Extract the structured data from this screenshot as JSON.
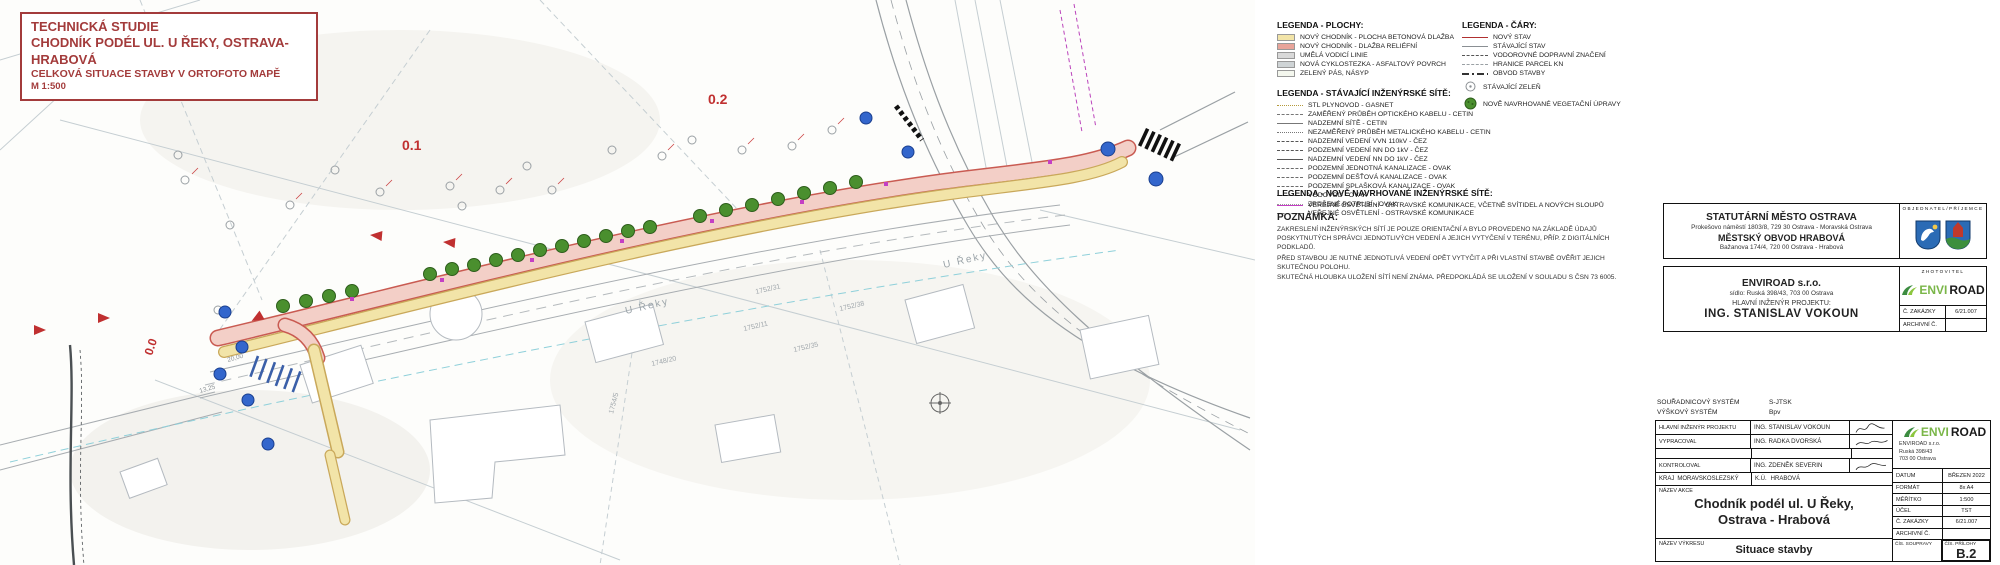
{
  "colors": {
    "title_red": "#a33b3b",
    "sidewalk_yellow": "#f2e4a8",
    "relief_red": "#e8a49a",
    "guide_gray": "#d9d9d9",
    "cycle_gray": "#cfd4d6",
    "green_strip": "#f4f7ee",
    "new_state_red": "#b03030",
    "lighting_magenta": "#c43fc4",
    "tree_green": "#4a8f2e",
    "sign_blue": "#3366cc",
    "logo_green": "#7ab648"
  },
  "title_box": {
    "line1": "TECHNICKÁ STUDIE",
    "line2": "CHODNÍK PODÉL UL. U ŘEKY, OSTRAVA-HRABOVÁ",
    "line3": "CELKOVÁ SITUACE STAVBY V ORTOFOTO MAPĚ",
    "line4": "M 1:500"
  },
  "legend_plochy": {
    "title": "LEGENDA - PLOCHY:",
    "items": [
      {
        "label": "NOVÝ CHODNÍK - PLOCHA BETONOVÁ DLAŽBA",
        "swatch": "#f2e4a8"
      },
      {
        "label": "NOVÝ CHODNÍK - DLAŽBA RELIÉFNÍ",
        "swatch": "#e8a49a"
      },
      {
        "label": "UMĚLÁ VODICÍ LINIE",
        "swatch": "#d9d9d9"
      },
      {
        "label": "NOVÁ CYKLOSTEZKA - ASFALTOVÝ POVRCH",
        "swatch": "#cfd4d6"
      },
      {
        "label": "ZELENÝ PÁS, NÁSYP",
        "swatch": "#f4f7ee"
      }
    ]
  },
  "legend_cary": {
    "title": "LEGENDA - ČÁRY:",
    "items": [
      {
        "label": "NOVÝ STAV",
        "style": "ln-s",
        "color": "#b03030"
      },
      {
        "label": "STÁVAJÍCÍ STAV",
        "style": "ln-s",
        "color": "#8a8f93"
      },
      {
        "label": "VODOROVNÉ DOPRAVNÍ ZNAČENÍ",
        "style": "ln-d",
        "color": "#555555"
      },
      {
        "label": "HRANICE PARCEL KN",
        "style": "ln-d",
        "color": "#9aa0a4"
      },
      {
        "label": "OBVOD STAVBY",
        "style": "ln-dd",
        "color": "#333333"
      }
    ],
    "symbols": [
      {
        "label": "STÁVAJÍCÍ ZELEŇ"
      },
      {
        "label": "NOVĚ NAVRHOVANÉ VEGETAČNÍ ÚPRAVY"
      }
    ]
  },
  "legend_stavajici": {
    "title": "LEGENDA - STÁVAJÍCÍ INŽENÝRSKÉ SÍTĚ:",
    "items": [
      {
        "label": "STL PLYNOVOD - GASNET",
        "style": "ln-t",
        "color": "#b59a3c"
      },
      {
        "label": "ZAMĚŘENÝ PRŮBĚH OPTICKÉHO KABELU - CETIN",
        "style": "ln-d",
        "color": "#777777"
      },
      {
        "label": "NADZEMNÍ SÍTĚ - CETIN",
        "style": "ln-s",
        "color": "#777777"
      },
      {
        "label": "NEZAMĚŘENÝ PRŮBĚH METALICKÉHO KABELU - CETIN",
        "style": "ln-t",
        "color": "#777777"
      },
      {
        "label": "NADZEMNÍ VEDENÍ VVN 110kV - ČEZ",
        "style": "ln-d",
        "color": "#555555"
      },
      {
        "label": "PODZEMNÍ VEDENÍ NN DO 1kV - ČEZ",
        "style": "ln-d",
        "color": "#555555"
      },
      {
        "label": "NADZEMNÍ VEDENÍ NN DO 1kV - ČEZ",
        "style": "ln-s",
        "color": "#555555"
      },
      {
        "label": "PODZEMNÍ JEDNOTNÁ KANALIZACE - OVAK",
        "style": "ln-d",
        "color": "#6b6b6b"
      },
      {
        "label": "PODZEMNÍ DEŠŤOVÁ KANALIZACE - OVAK",
        "style": "ln-d",
        "color": "#6b6b6b"
      },
      {
        "label": "PODZEMNÍ SPLAŠKOVÁ KANALIZACE - OVAK",
        "style": "ln-d",
        "color": "#6b6b6b"
      },
      {
        "label": "VODOVOD - OVAK",
        "style": "ln-s",
        "color": "#6b6b6b"
      },
      {
        "label": "ZRUŠENÉ POTRUBÍ - OVAK",
        "style": "ln-t",
        "color": "#999999"
      },
      {
        "label": "VEŘEJNÉ OSVĚTLENÍ - OSTRAVSKÉ KOMUNIKACE",
        "style": "ln-d",
        "color": "#888888"
      }
    ]
  },
  "legend_nove": {
    "title": "LEGENDA - NOVĚ NAVRHOVANÉ INŽENÝRSKÉ SÍTĚ:",
    "items": [
      {
        "label": "VEŘEJNÉ OSVĚTLENÍ - OSTRAVSKÉ KOMUNIKACE, VČETNĚ SVÍTIDEL A NOVÝCH SLOUPŮ",
        "style": "ln-s",
        "color": "#c43fc4"
      }
    ]
  },
  "poznamka": {
    "title": "POZNÁMKA:",
    "lines": [
      "ZAKRESLENÍ INŽENÝRSKÝCH SÍTÍ JE POUZE ORIENTAČNÍ A BYLO PROVEDENO NA ZÁKLADĚ ÚDAJŮ POSKYTNUTÝCH SPRÁVCI JEDNOTLIVÝCH VEDENÍ A JEJICH VYTYČENÍ V TERÉNU, PŘÍP. Z DIGITÁLNÍCH PODKLADŮ.",
      "PŘED STAVBOU JE NUTNÉ JEDNOTLIVÁ VEDENÍ OPĚT VYTYČIT A PŘI VLASTNÍ STAVBĚ OVĚŘIT JEJICH SKUTEČNOU POLOHU.",
      "SKUTEČNÁ HLOUBKA ULOŽENÍ SÍTÍ NENÍ ZNÁMA. PŘEDPOKLÁDÁ SE ULOŽENÍ V SOULADU S ČSN 73 6005."
    ]
  },
  "map": {
    "stations": [
      "0.0",
      "0.1",
      "0.2"
    ],
    "street_label": "U Řeky",
    "parcels": [
      "1752/31",
      "1752/11",
      "1752/38",
      "1752/35",
      "1748/20",
      "1754/5"
    ],
    "dimensions": [
      "20,00",
      "13,25"
    ]
  },
  "owner_block": {
    "corner_label": "OBJEDNATEL/PŘÍJEMCE",
    "line1": "STATUTÁRNÍ MĚSTO OSTRAVA",
    "line2": "Prokešovo náměstí 1803/8, 729 30 Ostrava - Moravská Ostrava",
    "line3": "MĚSTSKÝ OBVOD HRABOVÁ",
    "line4": "Bažanova 174/4, 720 00 Ostrava - Hrabová"
  },
  "contractor_block": {
    "corner_label": "ZHOTOVITEL",
    "company": "ENVIROAD s.r.o.",
    "address": "sídlo: Ruská 398/43, 703 00 Ostrava",
    "role_label": "HLAVNÍ INŽENÝR PROJEKTU:",
    "engineer": "ING. STANISLAV VOKOUN",
    "logo_envi": "ENVI",
    "logo_road": "ROAD",
    "zakazka_label": "Č. ZAKÁZKY",
    "zakazka_value": "6/21.007",
    "archiv_label": "ARCHIVNÍ Č.",
    "archiv_value": ""
  },
  "systems": {
    "coord_label": "SOUŘADNICOVÝ SYSTÉM",
    "coord_value": "S-JTSK",
    "height_label": "VÝŠKOVÝ SYSTÉM",
    "height_value": "Bpv"
  },
  "title_table": {
    "rows": [
      {
        "label": "HLAVNÍ INŽENÝR PROJEKTU",
        "value": "ING. STANISLAV VOKOUN"
      },
      {
        "label": "VYPRACOVAL",
        "value": "ING. RADKA DVORSKÁ"
      },
      {
        "label": "KONTROLOVAL",
        "value": "ING. ZDENĚK SEVERIN"
      }
    ],
    "kraj_label": "KRAJ",
    "kraj_value": "MORAVSKOSLEZSKÝ",
    "ku_label": "K.Ú.",
    "ku_value": "HRABOVÁ",
    "firm_name_envi": "ENVI",
    "firm_name_road": "ROAD",
    "firm_addr1": "ENVIROAD s.r.o.",
    "firm_addr2": "Ruská 398/43",
    "firm_addr3": "703 00 Ostrava",
    "datum_label": "DATUM",
    "datum_value": "BŘEZEN 2022",
    "format_label": "FORMÁT",
    "format_value": "8x A4",
    "meritko_label": "MĚŘÍTKO",
    "meritko_value": "1:500",
    "ucel_label": "ÚČEL",
    "ucel_value": "TST",
    "zakazka_label": "Č. ZAKÁZKY",
    "zakazka_value": "6/21.007",
    "archiv_label": "ARCHIVNÍ Č.",
    "archiv_value": "",
    "akce_label": "NÁZEV AKCE",
    "akce_line1": "Chodník podél ul. U Řeky,",
    "akce_line2": "Ostrava - Hrabová",
    "vykres_label": "NÁZEV VÝKRESU",
    "vykres_value": "Situace stavby",
    "souprava_label": "ČÍS. SOUPRAVY",
    "priloha_label": "ČÍS. PŘÍLOHY",
    "priloha_value": "B.2"
  }
}
